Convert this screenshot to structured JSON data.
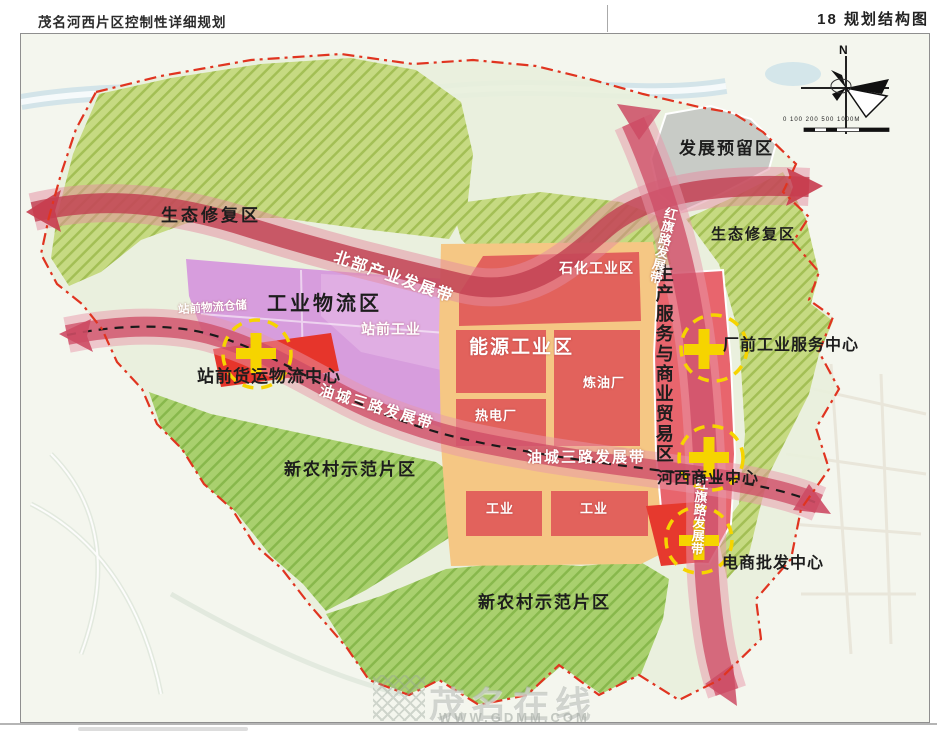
{
  "header": {
    "doc_title": "茂名河西片区控制性详细规划",
    "page_label": "18  规划结构图"
  },
  "zones": {
    "eco_left": "生态修复区",
    "eco_right": "生态修复区",
    "dev_reserve": "发展预留区",
    "industrial_logistics": "工业物流区",
    "station_industry": "站前工业",
    "station_warehouse": "站前物流仓储",
    "petrochemical": "石化工业区",
    "energy": "能源工业区",
    "refinery": "炼油厂",
    "thermal_plant": "热电厂",
    "industry_left": "工业",
    "industry_right": "工业",
    "rural_left": "新农村示范片区",
    "rural_bottom": "新农村示范片区",
    "production_service": "生产服务与商业贸易区"
  },
  "belts": {
    "north_industry": "北部产业发展带",
    "youcheng_left": "油城三路发展带",
    "youcheng_right": "油城三路发展带",
    "hongqi_top": "红旗路发展带",
    "hongqi_bottom": "红旗路发展带"
  },
  "centers": {
    "station_freight": "站前货运物流中心",
    "factory_front": "厂前工业服务中心",
    "hexi_commercial": "河西商业中心",
    "ecommerce": "电商批发中心"
  },
  "compass": {
    "north_label": "N",
    "scale_text": "0 100 200    500         1000M"
  },
  "watermark": {
    "site_name": "茂名在线",
    "site_url": "WWW.GDMM.COM"
  },
  "colors": {
    "boundary_red": "#e03420",
    "road_rose": "#cc4f68",
    "industrial_red": "#e2625c",
    "bright_red": "#e6352b",
    "logistics_purple": "#d79ddd",
    "orange_zone": "#f5c784",
    "eco_green": "#c6da82",
    "rural_green": "#a9d06e",
    "reserve_gray": "#c8cbc6",
    "marker_yellow": "#f6d400"
  }
}
